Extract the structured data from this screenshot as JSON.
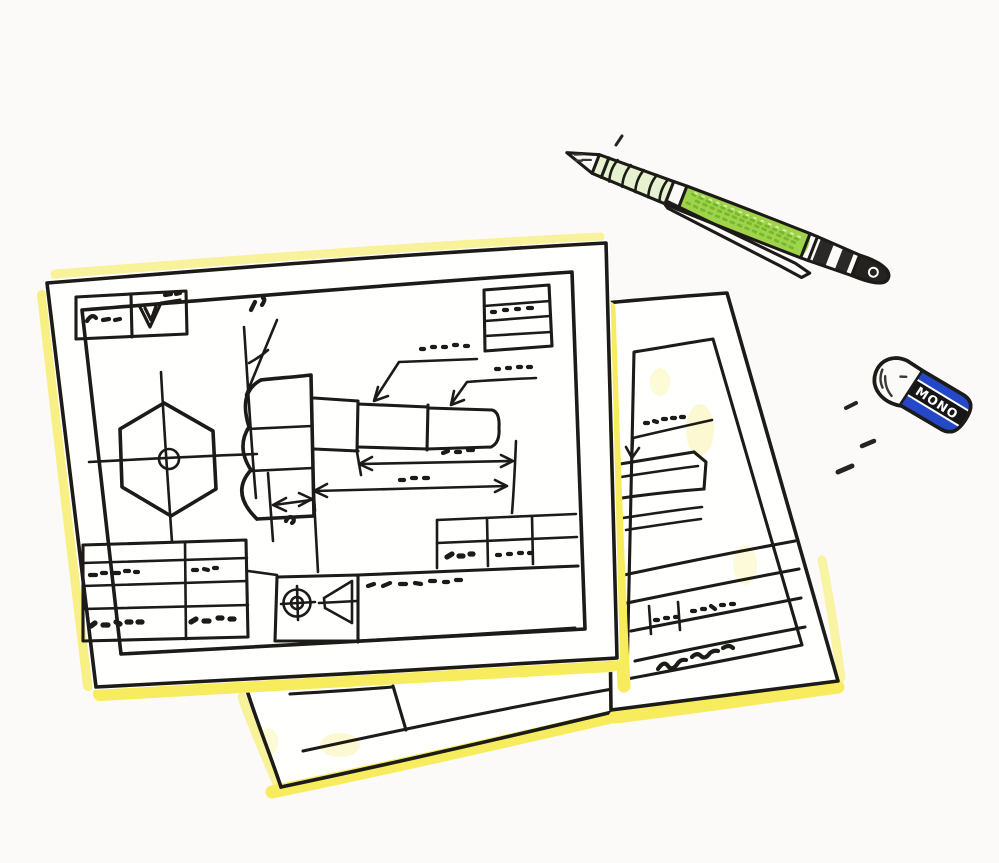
{
  "scene": {
    "title": "Hand-drawn sketch of engineering drawings with pencil and eraser",
    "description": "Ink sketch of two overlapping mechanical drawing sheets of a hex-head bolt, paper edges traced with yellow highlighter, a green mechanical pencil at top right and a MONO eraser at right",
    "background_color": "#fbfaf8"
  },
  "colors": {
    "ink": "#1d1b18",
    "paper": "#fffffe",
    "highlighter": "#f7ec5e",
    "highlighter_soft": "#faf3a6",
    "pencil_green": "#9fd34a",
    "pencil_green_dark": "#6fb32a",
    "pencil_green_light": "#d9f0a8",
    "grip_tint": "#e6f1cf",
    "eraser_blue": "#2448c8",
    "eraser_black": "#161616"
  },
  "front_sheet": {
    "name": "hex bolt drawing sheet",
    "features": [
      "outer and inner border",
      "surface-finish box top-left",
      "revision box top-right",
      "hex head front view with centerlines",
      "bolt side view with hex head and threaded shaft",
      "two leader-line callouts",
      "length dimension arrows",
      "chamfer angle callout",
      "title block grid with scribbled entries",
      "first-angle projection symbol",
      "parts table"
    ],
    "annotations_note": "all lettering is illegible handwritten scribble"
  },
  "back_sheet": {
    "name": "second drawing sheet",
    "features": [
      "outer and inner border",
      "leader-line callout with scribble",
      "partial view of cylindrical part",
      "title block rows with scribbled entries",
      "cursive scribble note"
    ]
  },
  "bottom_sheet": {
    "name": "third sheet corner",
    "features": [
      "border corner and one table cell peeking out below the front sheet"
    ]
  },
  "pencil": {
    "name": "mechanical pencil",
    "parts": [
      "metal tip",
      "ribbed grip",
      "green barrel",
      "pocket clip",
      "metal rear cap"
    ]
  },
  "eraser": {
    "name": "block eraser",
    "brand_text": "MONO",
    "parts": [
      "white eraser body",
      "sleeve with blue stripe, black logo band, blue stripe"
    ]
  },
  "debris": {
    "name": "graphite debris marks",
    "count": 4
  }
}
